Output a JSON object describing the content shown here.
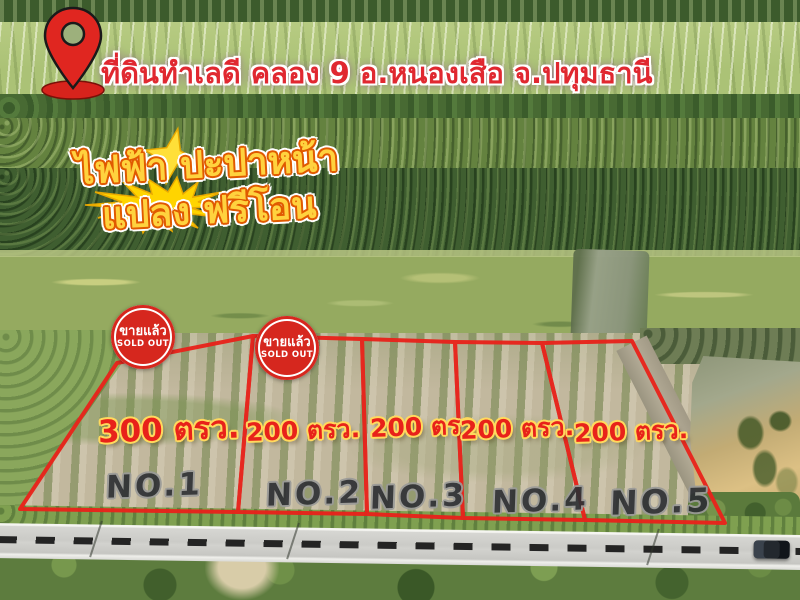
{
  "header": {
    "title": "ที่ดินทำเลดี คลอง 9 อ.หนองเสือ จ.ปทุมธานี"
  },
  "features": {
    "line1": "ไฟฟ้า ปะปาหน้า",
    "line2": "แปลง ฟรีโอน"
  },
  "sold_badge": {
    "thai": "ขายแล้ว",
    "english": "SOLD OUT"
  },
  "plots": [
    {
      "number": "NO.1",
      "size": "300 ตรว.",
      "sold": true
    },
    {
      "number": "NO.2",
      "size": "200 ตรว.",
      "sold": true
    },
    {
      "number": "NO.3",
      "size": "200 ตรว.",
      "sold": false
    },
    {
      "number": "NO.4",
      "size": "200 ตรว.",
      "sold": false
    },
    {
      "number": "NO.5",
      "size": "200 ตรว.",
      "sold": false
    }
  ],
  "colors": {
    "plot_outline_red": "#e8231b",
    "title_red": "#e02830",
    "feature_yellow": "#ffd23e",
    "badge_red": "#d6271e",
    "size_label_red": "#e8221a",
    "number_label_gray": "#2e3034"
  }
}
